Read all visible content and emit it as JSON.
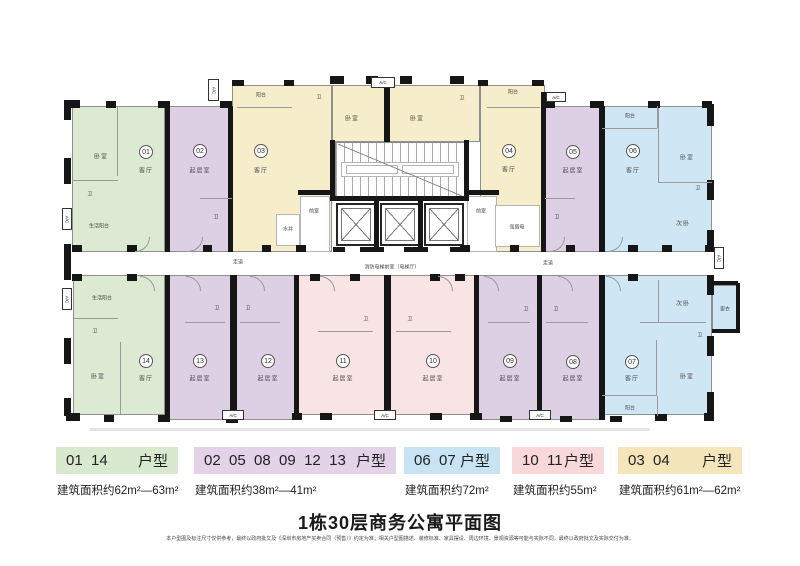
{
  "title": "1栋30层商务公寓平面图",
  "disclaimer": "本户型图及标注尺寸仅供参考，最终以政府批文及《深圳市房地产买卖合同（预售）》约定为准；相关户型图描述、装修标准、家具摆设、周边环境、景观资源等可能与实际不同，最终以政府批文及实际交付为准。",
  "legend": [
    {
      "numbers": "01  14",
      "type_label": "户型",
      "area": "建筑面积约62m²—63m²",
      "color": "#d9e9cf"
    },
    {
      "numbers": "02  05  08  09  12  13",
      "type_label": "户型",
      "area": "建筑面积约38m²—41m²",
      "color": "#e3d2e8"
    },
    {
      "numbers": "06  07",
      "type_label": "户型",
      "area": "建筑面积约72m²",
      "color": "#c7e3f4"
    },
    {
      "numbers": "10  11",
      "type_label": "户型",
      "area": "建筑面积约55m²",
      "color": "#f9d8da"
    },
    {
      "numbers": "03  04",
      "type_label": "户型",
      "area": "建筑面积约61m²—62m²",
      "color": "#f4e5ba"
    }
  ],
  "floorplan": {
    "ac_text": "A/C",
    "colors": {
      "green": "#dcead4",
      "purple": "#ddcfe4",
      "cream": "#f6edca",
      "blue": "#cfe7f5",
      "pink": "#f8e3e5"
    },
    "units": [
      {
        "n": "01",
        "f": "green",
        "x": 72,
        "y": 106,
        "w": 93,
        "h": 146,
        "nx": 146,
        "ny": 152
      },
      {
        "n": "02",
        "f": "purple",
        "x": 165,
        "y": 106,
        "w": 67,
        "h": 146,
        "nx": 200,
        "ny": 151
      },
      {
        "n": "03",
        "f": "cream",
        "x": 232,
        "y": 85,
        "w": 100,
        "h": 167,
        "nx": 261,
        "ny": 151
      },
      {
        "n": "04",
        "f": "cream",
        "x": 480,
        "y": 85,
        "w": 65,
        "h": 167,
        "nx": 509,
        "ny": 151
      },
      {
        "n": "05",
        "f": "purple",
        "x": 545,
        "y": 106,
        "w": 57,
        "h": 146,
        "nx": 573,
        "ny": 152
      },
      {
        "n": "06",
        "f": "blue",
        "x": 602,
        "y": 106,
        "w": 110,
        "h": 146,
        "nx": 633,
        "ny": 151
      },
      {
        "n": "14",
        "f": "green",
        "x": 73,
        "y": 275,
        "w": 92,
        "h": 140,
        "nx": 146,
        "ny": 361
      },
      {
        "n": "13",
        "f": "purple",
        "x": 165,
        "y": 275,
        "w": 68,
        "h": 145,
        "nx": 200,
        "ny": 361
      },
      {
        "n": "12",
        "f": "purple",
        "x": 233,
        "y": 275,
        "w": 65,
        "h": 145,
        "nx": 268,
        "ny": 361
      },
      {
        "n": "11",
        "f": "pink",
        "x": 298,
        "y": 275,
        "w": 90,
        "h": 140,
        "nx": 343,
        "ny": 361
      },
      {
        "n": "10",
        "f": "pink",
        "x": 388,
        "y": 275,
        "w": 90,
        "h": 140,
        "nx": 433,
        "ny": 361
      },
      {
        "n": "09",
        "f": "purple",
        "x": 478,
        "y": 275,
        "w": 62,
        "h": 145,
        "nx": 510,
        "ny": 361
      },
      {
        "n": "08",
        "f": "purple",
        "x": 540,
        "y": 275,
        "w": 62,
        "h": 145,
        "nx": 573,
        "ny": 362
      },
      {
        "n": "07",
        "f": "blue",
        "x": 602,
        "y": 275,
        "w": 110,
        "h": 140,
        "nx": 632,
        "ny": 362
      }
    ],
    "areas": [
      {
        "f": "cream",
        "x": 332,
        "y": 85,
        "w": 148,
        "h": 57
      },
      {
        "f": "blue",
        "x": 712,
        "y": 285,
        "w": 26,
        "h": 48
      }
    ],
    "white_rooms": [
      [
        300,
        196,
        30,
        56
      ],
      [
        467,
        196,
        30,
        56
      ],
      [
        276,
        214,
        24,
        32
      ],
      [
        495,
        205,
        45,
        42
      ]
    ],
    "labels": [
      {
        "t": "卧室",
        "x": 101,
        "y": 156
      },
      {
        "t": "客厅",
        "x": 146,
        "y": 170
      },
      {
        "t": "卫",
        "x": 90,
        "y": 194,
        "s": 1
      },
      {
        "t": "生活阳台",
        "x": 99,
        "y": 226,
        "s": 1
      },
      {
        "t": "起居室",
        "x": 200,
        "y": 170
      },
      {
        "t": "卫",
        "x": 216,
        "y": 217,
        "s": 1
      },
      {
        "t": "阳台",
        "x": 261,
        "y": 95,
        "s": 1
      },
      {
        "t": "客厅",
        "x": 261,
        "y": 170
      },
      {
        "t": "卫",
        "x": 319,
        "y": 97,
        "s": 1
      },
      {
        "t": "卧室",
        "x": 352,
        "y": 118
      },
      {
        "t": "卧室",
        "x": 417,
        "y": 118
      },
      {
        "t": "卫",
        "x": 462,
        "y": 98,
        "s": 1
      },
      {
        "t": "阳台",
        "x": 513,
        "y": 92,
        "s": 1
      },
      {
        "t": "客厅",
        "x": 509,
        "y": 169
      },
      {
        "t": "强弱电",
        "x": 517,
        "y": 227,
        "s": 1
      },
      {
        "t": "水井",
        "x": 288,
        "y": 229,
        "s": 1
      },
      {
        "t": "前室",
        "x": 314,
        "y": 211,
        "s": 1
      },
      {
        "t": "前室",
        "x": 481,
        "y": 211,
        "s": 1
      },
      {
        "t": "起居室",
        "x": 573,
        "y": 170
      },
      {
        "t": "卫",
        "x": 557,
        "y": 217,
        "s": 1
      },
      {
        "t": "阳台",
        "x": 630,
        "y": 116,
        "s": 1
      },
      {
        "t": "客厅",
        "x": 633,
        "y": 170
      },
      {
        "t": "卧室",
        "x": 687,
        "y": 157
      },
      {
        "t": "卫",
        "x": 698,
        "y": 188,
        "s": 1
      },
      {
        "t": "次卧",
        "x": 683,
        "y": 223
      },
      {
        "t": "走道",
        "x": 238,
        "y": 262,
        "s": 1
      },
      {
        "t": "走道",
        "x": 548,
        "y": 263,
        "s": 1
      },
      {
        "t": "消防电梯前室（电梯厅）",
        "x": 392,
        "y": 267,
        "s": 1
      },
      {
        "t": "生活阳台",
        "x": 102,
        "y": 298,
        "s": 1
      },
      {
        "t": "卫",
        "x": 95,
        "y": 331,
        "s": 1
      },
      {
        "t": "卧室",
        "x": 98,
        "y": 376
      },
      {
        "t": "客厅",
        "x": 146,
        "y": 378
      },
      {
        "t": "起居室",
        "x": 200,
        "y": 378
      },
      {
        "t": "卫",
        "x": 217,
        "y": 308,
        "s": 1
      },
      {
        "t": "起居室",
        "x": 268,
        "y": 378
      },
      {
        "t": "卫",
        "x": 248,
        "y": 308,
        "s": 1
      },
      {
        "t": "起居室",
        "x": 343,
        "y": 378
      },
      {
        "t": "卫",
        "x": 366,
        "y": 319,
        "s": 1
      },
      {
        "t": "起居室",
        "x": 433,
        "y": 378
      },
      {
        "t": "卫",
        "x": 410,
        "y": 319,
        "s": 1
      },
      {
        "t": "起居室",
        "x": 510,
        "y": 378
      },
      {
        "t": "卫",
        "x": 526,
        "y": 309,
        "s": 1
      },
      {
        "t": "起居室",
        "x": 573,
        "y": 378
      },
      {
        "t": "卫",
        "x": 556,
        "y": 309,
        "s": 1
      },
      {
        "t": "客厅",
        "x": 632,
        "y": 378
      },
      {
        "t": "次卧",
        "x": 683,
        "y": 303
      },
      {
        "t": "卫",
        "x": 700,
        "y": 335,
        "s": 1
      },
      {
        "t": "卧室",
        "x": 687,
        "y": 376
      },
      {
        "t": "阳台",
        "x": 630,
        "y": 408,
        "s": 1
      },
      {
        "t": "更衣",
        "x": 725,
        "y": 309,
        "s": 1
      }
    ],
    "walls": [
      [
        165,
        106,
        5,
        146
      ],
      [
        228,
        106,
        5,
        146
      ],
      [
        384,
        83,
        6,
        59
      ],
      [
        541,
        92,
        5,
        160
      ],
      [
        599,
        106,
        6,
        146
      ],
      [
        165,
        275,
        5,
        145
      ],
      [
        230,
        275,
        7,
        145
      ],
      [
        294,
        275,
        5,
        140
      ],
      [
        384,
        275,
        7,
        140
      ],
      [
        474,
        275,
        5,
        140
      ],
      [
        537,
        275,
        5,
        145
      ],
      [
        599,
        275,
        6,
        145
      ],
      [
        330,
        140,
        5,
        60
      ],
      [
        464,
        140,
        5,
        60
      ],
      [
        330,
        196,
        139,
        5
      ],
      [
        374,
        201,
        5,
        46
      ],
      [
        418,
        201,
        5,
        46
      ],
      [
        333,
        247,
        12,
        5
      ],
      [
        360,
        247,
        24,
        5
      ],
      [
        404,
        247,
        24,
        5
      ],
      [
        450,
        247,
        16,
        5
      ],
      [
        298,
        190,
        34,
        5
      ],
      [
        465,
        190,
        34,
        5
      ],
      [
        66,
        100,
        14,
        8
      ],
      [
        106,
        101,
        10,
        7
      ],
      [
        158,
        101,
        12,
        7
      ],
      [
        220,
        101,
        12,
        7
      ],
      [
        232,
        80,
        12,
        6
      ],
      [
        284,
        80,
        10,
        6
      ],
      [
        330,
        76,
        14,
        8
      ],
      [
        366,
        76,
        12,
        8
      ],
      [
        400,
        76,
        12,
        8
      ],
      [
        450,
        76,
        14,
        8
      ],
      [
        478,
        80,
        10,
        6
      ],
      [
        532,
        80,
        12,
        6
      ],
      [
        545,
        101,
        10,
        7
      ],
      [
        590,
        101,
        14,
        7
      ],
      [
        648,
        101,
        12,
        7
      ],
      [
        702,
        101,
        10,
        7
      ],
      [
        64,
        100,
        7,
        20
      ],
      [
        64,
        158,
        7,
        26
      ],
      [
        64,
        244,
        7,
        36
      ],
      [
        64,
        338,
        7,
        26
      ],
      [
        64,
        398,
        7,
        18
      ],
      [
        707,
        104,
        7,
        22
      ],
      [
        707,
        180,
        7,
        20
      ],
      [
        707,
        230,
        7,
        22
      ],
      [
        707,
        275,
        7,
        20
      ],
      [
        707,
        336,
        7,
        20
      ],
      [
        707,
        392,
        7,
        23
      ],
      [
        712,
        281,
        26,
        4
      ],
      [
        712,
        329,
        26,
        4
      ],
      [
        736,
        283,
        4,
        50
      ],
      [
        66,
        413,
        14,
        8
      ],
      [
        104,
        415,
        10,
        7
      ],
      [
        158,
        415,
        12,
        7
      ],
      [
        226,
        417,
        12,
        6
      ],
      [
        292,
        413,
        10,
        7
      ],
      [
        320,
        413,
        12,
        7
      ],
      [
        380,
        413,
        14,
        7
      ],
      [
        430,
        413,
        12,
        7
      ],
      [
        470,
        413,
        12,
        7
      ],
      [
        500,
        416,
        12,
        6
      ],
      [
        560,
        416,
        12,
        6
      ],
      [
        610,
        416,
        12,
        6
      ],
      [
        655,
        414,
        12,
        7
      ],
      [
        704,
        413,
        10,
        8
      ],
      [
        72,
        245,
        10,
        7
      ],
      [
        127,
        245,
        10,
        7
      ],
      [
        203,
        245,
        9,
        7
      ],
      [
        262,
        245,
        9,
        7
      ],
      [
        296,
        245,
        10,
        7
      ],
      [
        460,
        245,
        10,
        7
      ],
      [
        510,
        245,
        9,
        7
      ],
      [
        566,
        245,
        9,
        7
      ],
      [
        628,
        245,
        10,
        7
      ],
      [
        662,
        245,
        10,
        7
      ],
      [
        705,
        245,
        9,
        7
      ],
      [
        72,
        274,
        10,
        7
      ],
      [
        127,
        274,
        10,
        7
      ],
      [
        310,
        274,
        10,
        7
      ],
      [
        350,
        274,
        10,
        7
      ],
      [
        430,
        274,
        10,
        7
      ],
      [
        455,
        274,
        10,
        7
      ],
      [
        628,
        274,
        10,
        7
      ]
    ],
    "lines": [
      [
        117,
        106,
        1,
        70
      ],
      [
        72,
        180,
        46,
        1
      ],
      [
        200,
        198,
        32,
        1
      ],
      [
        237,
        107,
        55,
        1
      ],
      [
        487,
        107,
        53,
        1
      ],
      [
        602,
        128,
        55,
        1
      ],
      [
        657,
        106,
        1,
        22
      ],
      [
        658,
        108,
        1,
        74
      ],
      [
        658,
        182,
        54,
        1
      ],
      [
        545,
        198,
        30,
        1
      ],
      [
        120,
        342,
        1,
        72
      ],
      [
        73,
        318,
        45,
        1
      ],
      [
        185,
        322,
        40,
        1
      ],
      [
        240,
        322,
        40,
        1
      ],
      [
        318,
        331,
        55,
        1
      ],
      [
        396,
        331,
        55,
        1
      ],
      [
        488,
        322,
        42,
        1
      ],
      [
        546,
        322,
        42,
        1
      ],
      [
        658,
        280,
        1,
        42
      ],
      [
        640,
        322,
        66,
        1
      ],
      [
        656,
        340,
        1,
        55
      ],
      [
        602,
        395,
        55,
        1
      ],
      [
        657,
        396,
        1,
        20
      ]
    ],
    "ac_boxes": [
      [
        371,
        77,
        24,
        11,
        0
      ],
      [
        208,
        79,
        11,
        22,
        1
      ],
      [
        546,
        92,
        20,
        10,
        0
      ],
      [
        374,
        410,
        22,
        10,
        0
      ],
      [
        222,
        410,
        22,
        10,
        0
      ],
      [
        529,
        410,
        22,
        10,
        0
      ],
      [
        62,
        208,
        10,
        22,
        1
      ],
      [
        62,
        288,
        10,
        22,
        1
      ],
      [
        714,
        247,
        10,
        22,
        1
      ]
    ],
    "arcs": [
      [
        135,
        237,
        "br"
      ],
      [
        188,
        237,
        "br"
      ],
      [
        550,
        237,
        "br"
      ],
      [
        608,
        237,
        "br"
      ],
      [
        140,
        276,
        "tr"
      ],
      [
        186,
        276,
        "tr"
      ],
      [
        250,
        276,
        "tr"
      ],
      [
        320,
        276,
        "tr"
      ],
      [
        438,
        276,
        "tr"
      ],
      [
        484,
        276,
        "tr"
      ],
      [
        558,
        276,
        "tr"
      ],
      [
        606,
        276,
        "tr"
      ]
    ],
    "ground": [
      90,
      428,
      560,
      3
    ]
  }
}
